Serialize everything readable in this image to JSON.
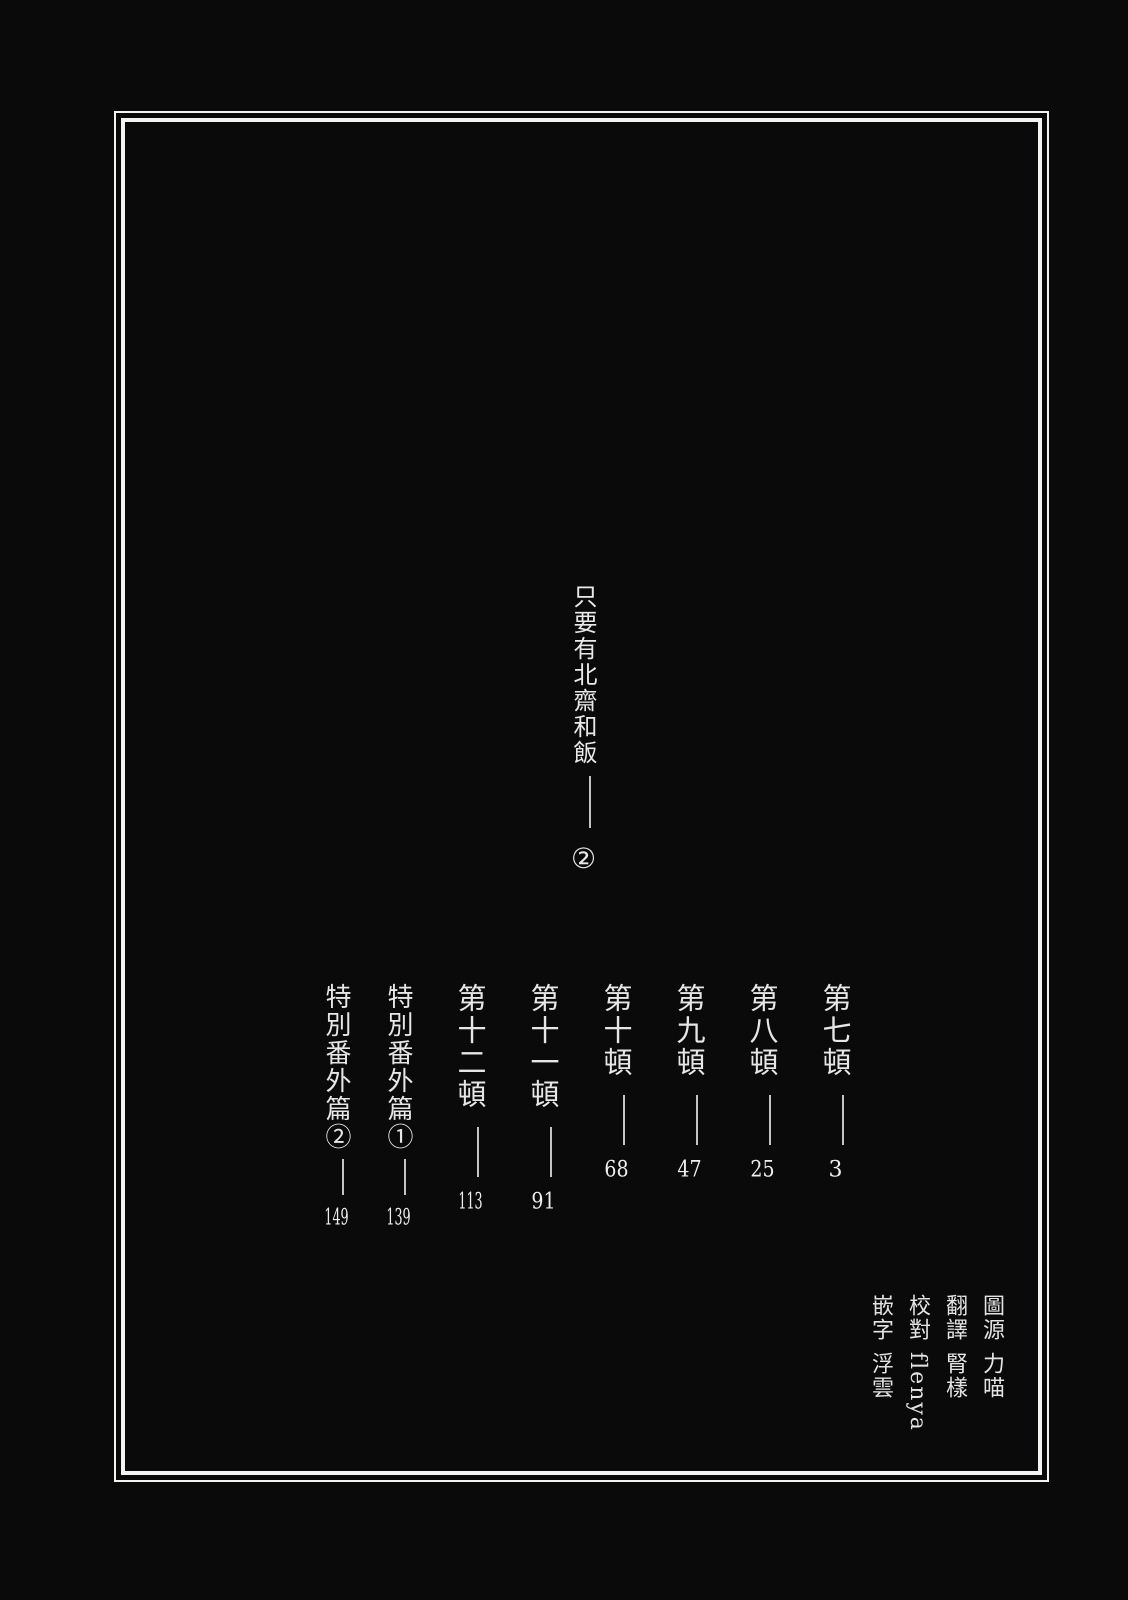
{
  "page": {
    "series_title": "只要有北齋和飯",
    "volume_mark": "②"
  },
  "toc": {
    "entries": [
      {
        "label": "第七頓",
        "page": "3"
      },
      {
        "label": "第八頓",
        "page": "25"
      },
      {
        "label": "第九頓",
        "page": "47"
      },
      {
        "label": "第十頓",
        "page": "68"
      },
      {
        "label": "第十一頓",
        "page": "91"
      },
      {
        "label": "第十二頓",
        "page": "113"
      },
      {
        "label": "特別番外篇①",
        "page": "139"
      },
      {
        "label": "特別番外篇②",
        "page": "149"
      }
    ]
  },
  "credits": [
    {
      "role": "圖源",
      "name": "力喵"
    },
    {
      "role": "翻譯",
      "name": "腎樣"
    },
    {
      "role": "校對",
      "name": "flenya"
    },
    {
      "role": "嵌字",
      "name": "浮雲"
    }
  ],
  "colors": {
    "background": "#0a0a0a",
    "text": "#e6e6e6",
    "border": "#f4f4f1",
    "leader_line": "#c4c4c4"
  }
}
